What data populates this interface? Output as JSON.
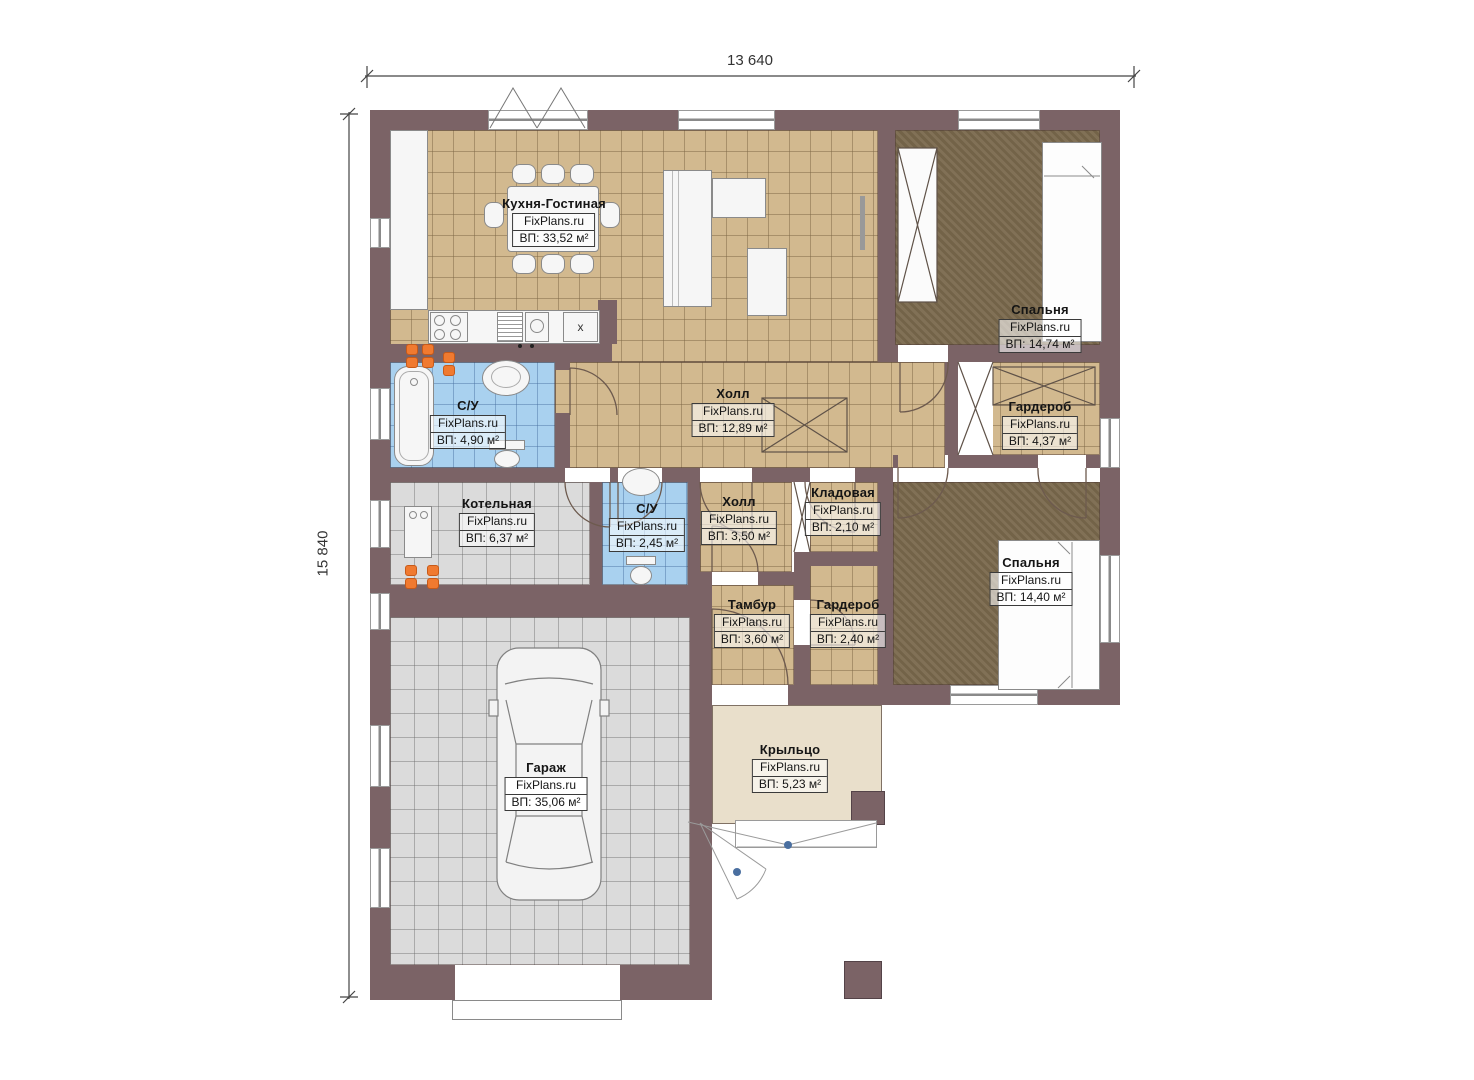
{
  "dimensions": {
    "width": "13 640",
    "height": "15 840"
  },
  "watermark": "FixPlans.ru",
  "kitchen_fridge_mark": "x",
  "rooms": [
    {
      "name": "Кухня-Гостиная",
      "area": "ВП: 33,52 м²"
    },
    {
      "name": "Спальня",
      "area": "ВП: 14,74 м²"
    },
    {
      "name": "Холл",
      "area": "ВП: 12,89 м²"
    },
    {
      "name": "С/У",
      "area": "ВП: 4,90 м²"
    },
    {
      "name": "Гардероб",
      "area": "ВП: 4,37 м²"
    },
    {
      "name": "Котельная",
      "area": "ВП: 6,37 м²"
    },
    {
      "name": "С/У",
      "area": "ВП: 2,45 м²"
    },
    {
      "name": "Холл",
      "area": "ВП: 3,50 м²"
    },
    {
      "name": "Кладовая",
      "area": "ВП: 2,10 м²"
    },
    {
      "name": "Спальня",
      "area": "ВП: 14,40 м²"
    },
    {
      "name": "Тамбур",
      "area": "ВП: 3,60 м²"
    },
    {
      "name": "Гардероб",
      "area": "ВП: 2,40 м²"
    },
    {
      "name": "Гараж",
      "area": "ВП: 35,06 м²"
    },
    {
      "name": "Крыльцо",
      "area": "ВП: 5,23 м²"
    }
  ],
  "colors": {
    "wall": "#7b6366",
    "floor_tan": "#d2b98f",
    "floor_blue": "#a9d1ef",
    "floor_gray": "#dbdbdb",
    "floor_carpet": "#7a694d",
    "porch": "#e9dfcb",
    "radiator": "#f07a30"
  }
}
